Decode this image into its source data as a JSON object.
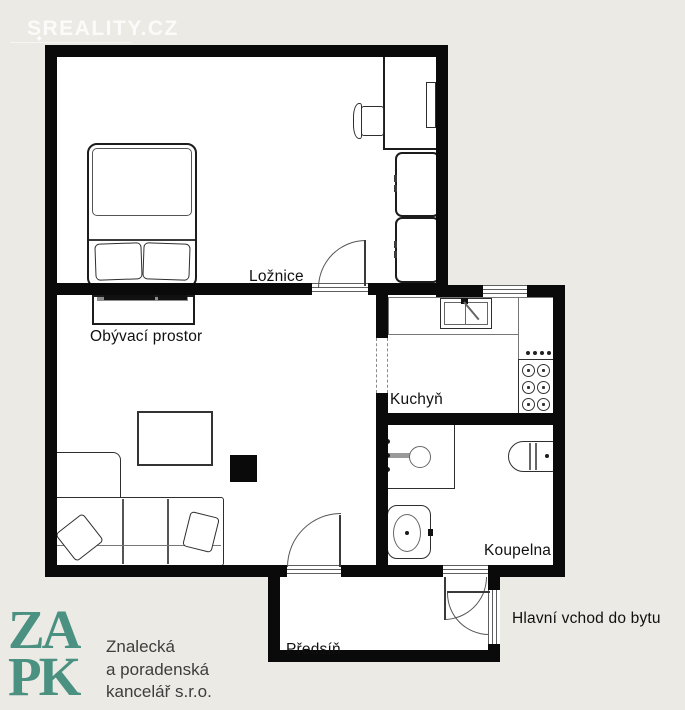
{
  "watermark": {
    "text": "SREALITY.CZ",
    "sparkle": "✦"
  },
  "rooms": {
    "bedroom": {
      "label": "Ložnice"
    },
    "living": {
      "label": "Obývací prostor"
    },
    "kitchen": {
      "label": "Kuchyň"
    },
    "bathroom": {
      "label": "Koupelna"
    },
    "hallway": {
      "label": "Předsíň"
    },
    "entrance": {
      "label": "Hlavní vchod do bytu"
    }
  },
  "logo": {
    "monogram_line1": "ZA",
    "monogram_line2": "PK",
    "company_line1": "Znalecká",
    "company_line2": "a poradenská",
    "company_line3": "kancelář s.r.o."
  },
  "colors": {
    "background": "#eceae4",
    "floor": "#ffffff",
    "wall": "#0a0a0a",
    "logo_teal": "#4a9182",
    "label_text": "#101010"
  }
}
